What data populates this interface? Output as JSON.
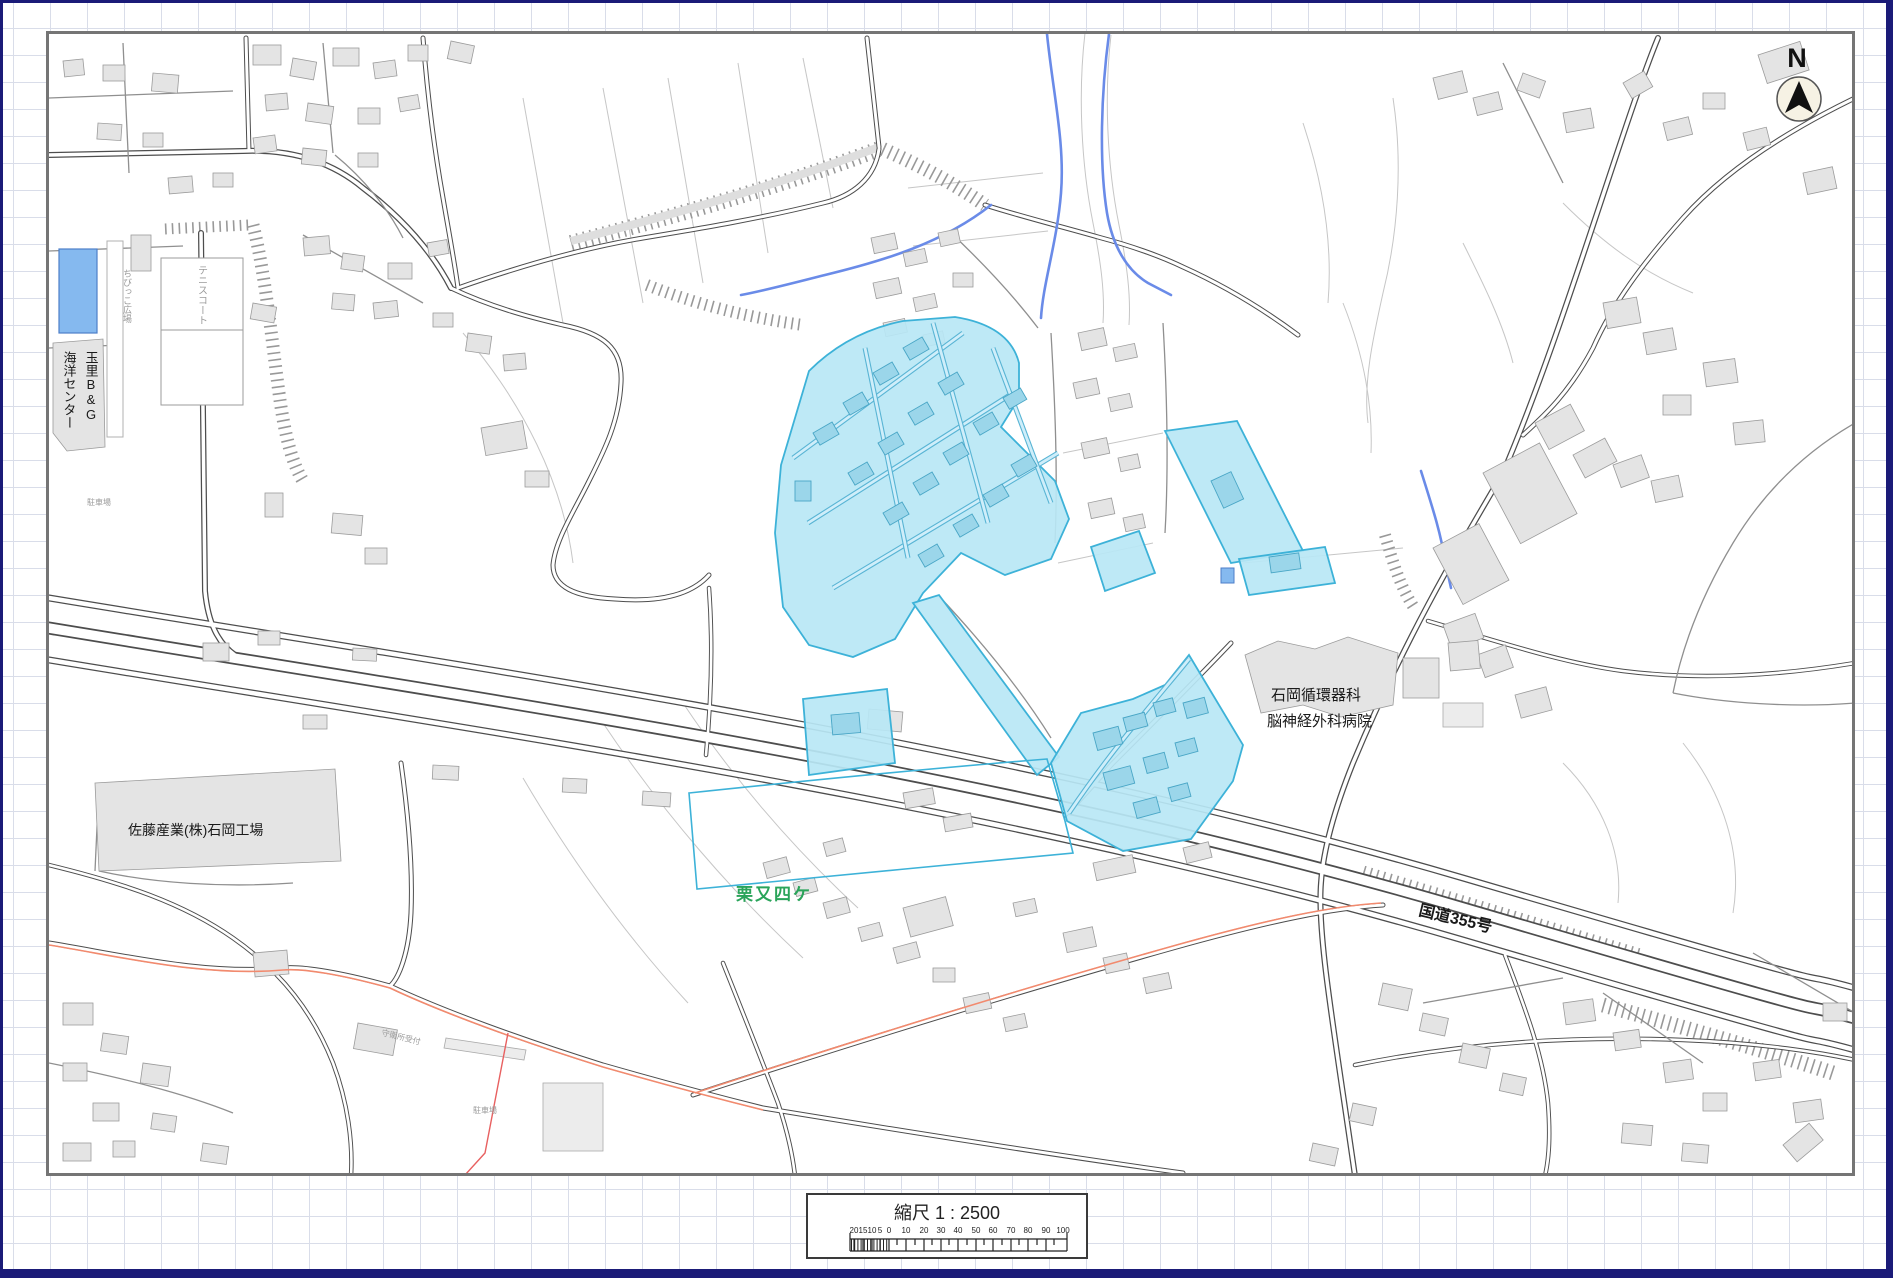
{
  "window": {
    "border_color": "#1b1b78",
    "grid_color": "#d9dde9",
    "frame_color": "#757575"
  },
  "compass": {
    "letter": "N"
  },
  "scalebar": {
    "title": "縮尺  1 : 2500",
    "ticks": [
      "20",
      "15",
      "10",
      "5",
      "0",
      "10",
      "20",
      "30",
      "40",
      "50",
      "60",
      "70",
      "80",
      "90",
      "100"
    ]
  },
  "map_labels": {
    "bg_center_line1": "玉里B&G",
    "bg_center_line2": "海洋センター",
    "tennis_court": "テニスコート",
    "kids_plaza": "ちびっこ広場",
    "parking_a": "駐車場",
    "parking_b": "駐車場",
    "guard_office": "守衛所受付",
    "factory": "佐藤産業(株)石岡工場",
    "district": "栗又四ケ",
    "hospital_line1": "石岡循環器科",
    "hospital_line2": "脳神経外科病院",
    "route": "国道355号"
  },
  "colors": {
    "highlight_fill": "#b9e7f5",
    "highlight_stroke": "#3db2d8",
    "highlight_building": "#9bd6ea",
    "water": "#6a8be8",
    "pool": "#85b9ef",
    "district_green": "#2aa45a",
    "accent_orange": "#f28a6e",
    "accent_red": "#e86060",
    "building_gray": "#e4e4e4",
    "road_casing": "#4d4d4d"
  }
}
